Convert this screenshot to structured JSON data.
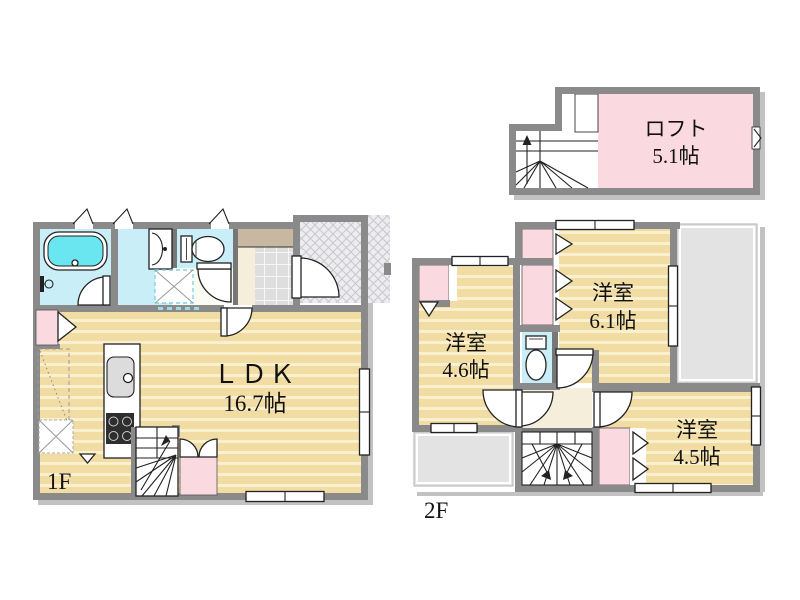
{
  "plan": {
    "floor1": {
      "label": "1F",
      "ldk": {
        "name": "ＬＤＫ",
        "size": "16.7帖"
      }
    },
    "floor2": {
      "label": "2F",
      "room_top": {
        "name": "洋室",
        "size": "6.1帖"
      },
      "room_left": {
        "name": "洋室",
        "size": "4.6帖"
      },
      "room_bottom": {
        "name": "洋室",
        "size": "4.5帖"
      }
    },
    "loft": {
      "name": "ロフト",
      "size": "5.1帖"
    }
  },
  "colors": {
    "wall": "#8a8a8a",
    "thin_wall": "#777777",
    "wood_floor": "#f1dda3",
    "wood_stripe": "#faf0cf",
    "wet_room": "#c9eef8",
    "bathtub": "#69e6f0",
    "closet_pink": "#fbd9e1",
    "hall_beige": "#f5eedb",
    "entry_step_brown": "#c8b7a1",
    "entry_tile": "#dedede",
    "porch_lattice": "#ededf0",
    "roof_gray": "#e3e3e3",
    "shadow": "#c2c2c2",
    "outline": "#222222"
  }
}
